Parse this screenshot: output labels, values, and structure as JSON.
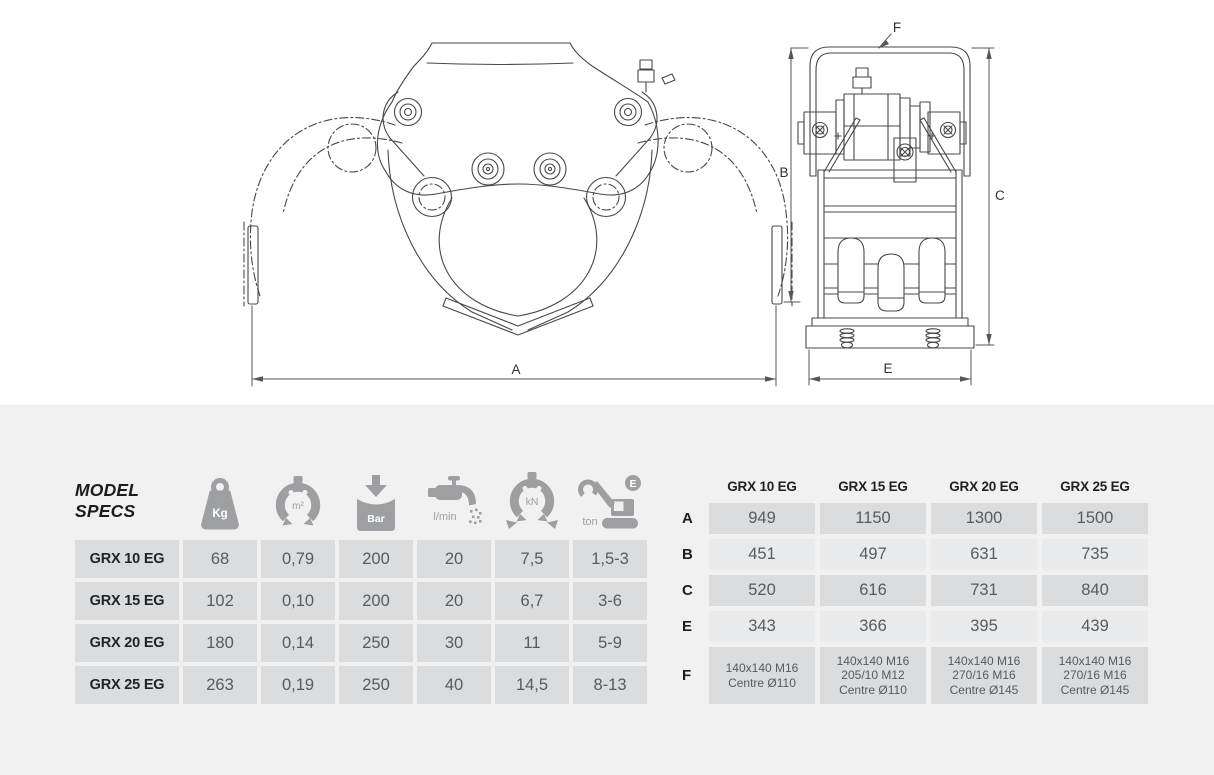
{
  "drawing": {
    "labels": {
      "A": "A",
      "B": "B",
      "C": "C",
      "E": "E",
      "F": "F"
    }
  },
  "specs_table": {
    "title_line1": "MODEL",
    "title_line2": "SPECS",
    "columns": [
      {
        "icon": "weight-kg-icon",
        "label": "Kg"
      },
      {
        "icon": "grapple-area-icon",
        "label": "m²"
      },
      {
        "icon": "pressure-bar-icon",
        "label": "Bar"
      },
      {
        "icon": "flow-lmin-icon",
        "label": "l/min"
      },
      {
        "icon": "closing-force-kn-icon",
        "label": "kN"
      },
      {
        "icon": "excavator-ton-icon",
        "label": "ton",
        "badge": "E"
      }
    ],
    "rows": [
      {
        "model": "GRX 10 EG",
        "values": [
          "68",
          "0,79",
          "200",
          "20",
          "7,5",
          "1,5-3"
        ]
      },
      {
        "model": "GRX 15 EG",
        "values": [
          "102",
          "0,10",
          "200",
          "20",
          "6,7",
          "3-6"
        ]
      },
      {
        "model": "GRX 20 EG",
        "values": [
          "180",
          "0,14",
          "250",
          "30",
          "11",
          "5-9"
        ]
      },
      {
        "model": "GRX 25 EG",
        "values": [
          "263",
          "0,19",
          "250",
          "40",
          "14,5",
          "8-13"
        ]
      }
    ]
  },
  "dimensions_table": {
    "columns": [
      "GRX 10 EG",
      "GRX 15 EG",
      "GRX 20 EG",
      "GRX 25 EG"
    ],
    "rows": [
      {
        "label": "A",
        "values": [
          "949",
          "1150",
          "1300",
          "1500"
        ]
      },
      {
        "label": "B",
        "values": [
          "451",
          "497",
          "631",
          "735"
        ]
      },
      {
        "label": "C",
        "values": [
          "520",
          "616",
          "731",
          "840"
        ]
      },
      {
        "label": "E",
        "values": [
          "343",
          "366",
          "395",
          "439"
        ]
      },
      {
        "label": "F",
        "values": [
          [
            "140x140 M16",
            "Centre Ø110"
          ],
          [
            "140x140 M16",
            "205/10 M12",
            "Centre Ø110"
          ],
          [
            "140x140 M16",
            "270/16 M16",
            "Centre Ø145"
          ],
          [
            "140x140 M16",
            "270/16 M16",
            "Centre Ø145"
          ]
        ]
      }
    ]
  },
  "colors": {
    "page_background": "#f1f1f2",
    "panel_background": "#ffffff",
    "cell_dark": "#dbdcdd",
    "cell_light": "#e9eaeb",
    "icon_gray": "#9d9fa2",
    "text_dark": "#1d1e20",
    "text_value": "#595a5d",
    "line": "#47484a"
  }
}
